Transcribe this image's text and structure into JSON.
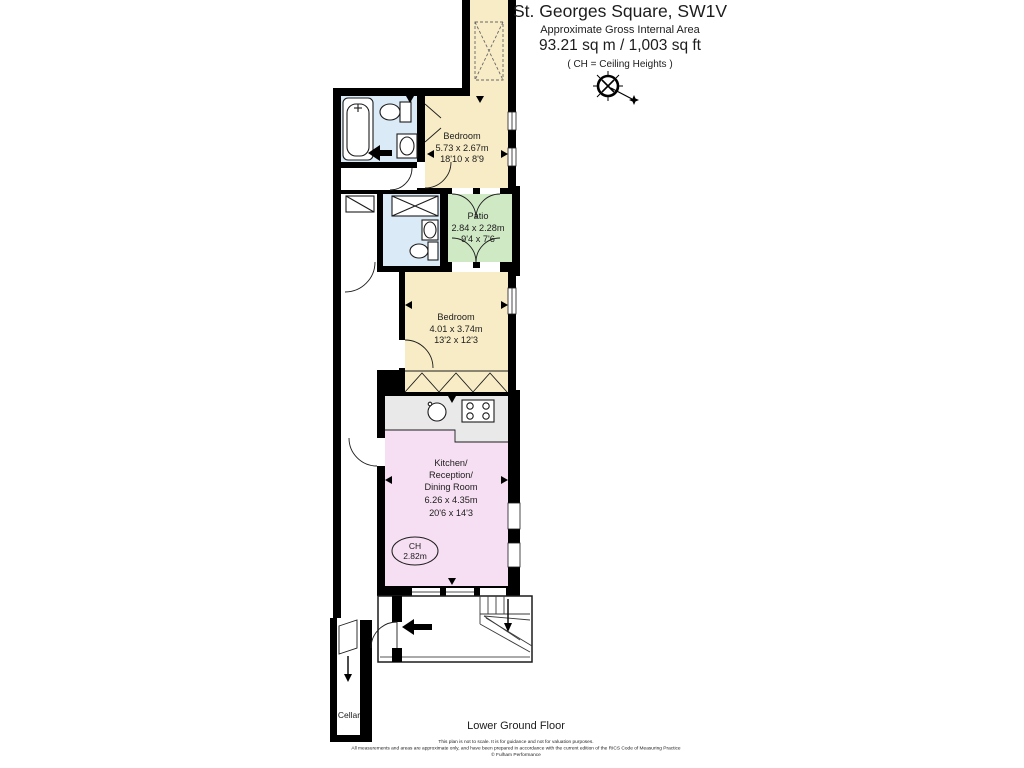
{
  "header": {
    "title": "St. Georges Square, SW1V",
    "subtitle": "Approximate Gross Internal Area",
    "area": "93.21 sq m  /  1,003 sq ft",
    "ch_note": "( CH = Ceiling Heights )"
  },
  "rooms": {
    "bedroom1": {
      "name": "Bedroom",
      "size_metric": "5.73 x 2.67m",
      "size_imperial": "18'10 x 8'9"
    },
    "patio": {
      "name": "Patio",
      "size_metric": "2.84 x 2.28m",
      "size_imperial": "9'4 x 7'6"
    },
    "bedroom2": {
      "name": "Bedroom",
      "size_metric": "4.01 x 3.74m",
      "size_imperial": "13'2 x 12'3"
    },
    "kitchen": {
      "name_line1": "Kitchen/",
      "name_line2": "Reception/",
      "name_line3": "Dining Room",
      "size_metric": "6.26 x 4.35m",
      "size_imperial": "20'6 x 14'3"
    },
    "cellar": {
      "name": "Cellar"
    }
  },
  "ch_badge": {
    "label": "CH",
    "value": "2.82m"
  },
  "footer": {
    "floor_label": "Lower Ground Floor",
    "disclaimer1": "This plan is not to scale. It is for guidance and not for valuation purposes.",
    "disclaimer2": "All measurements and areas are approximate only, and have been prepared in accordance with the current edition of the RICS Code of Measuring Practice",
    "disclaimer3": "© Fulham Performance"
  },
  "colors": {
    "wall": "#000000",
    "bedroom": "#f8ecc6",
    "patio": "#cfe9c5",
    "bathroom": "#dbeaf7",
    "kitchen": "#f7dff3",
    "counter": "#e9e9e9",
    "external": "#ffffff"
  }
}
